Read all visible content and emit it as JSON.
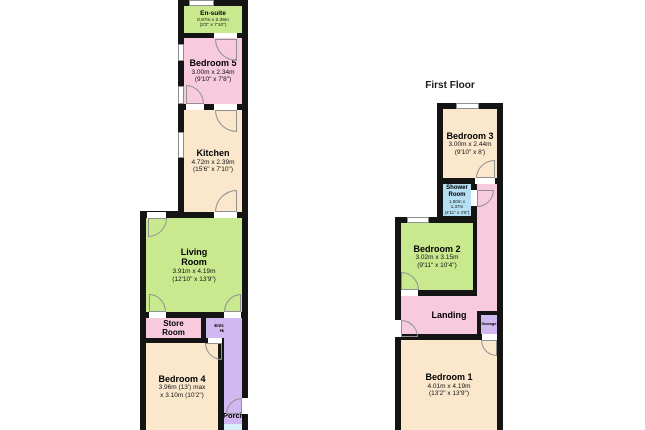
{
  "colors": {
    "wall": "#141414",
    "green": "#c9e98f",
    "pink": "#f7cade",
    "cream": "#fbe8cc",
    "lilac": "#d2b8f0",
    "blue": "#b5dff2",
    "porch_blue": "#d8eefb",
    "arc": "#909090",
    "window_frame": "#8e8e8e"
  },
  "first_floor_title": "First Floor",
  "ground": {
    "en_suite": {
      "name": "En-suite",
      "metric": "0.97m x 2.39m",
      "imperial": "(3'2\" x 7'10\")"
    },
    "bedroom5": {
      "name": "Bedroom 5",
      "metric": "3.00m x 2.34m",
      "imperial": "(9'10\" x 7'8\")"
    },
    "kitchen": {
      "name": "Kitchen",
      "metric": "4.72m x 2.39m",
      "imperial": "(15'6\" x 7'10\")"
    },
    "living_room": {
      "name": "Living Room",
      "metric": "3.91m x 4.19m",
      "imperial": "(12'10\" x 13'9\")"
    },
    "store_room": {
      "name": "Store Room"
    },
    "entrance_hall": {
      "name": "Entrance Hall"
    },
    "bedroom4": {
      "name": "Bedroom 4",
      "metric": "3.96m (13') max",
      "imperial": "x 3.10m (10'2\")"
    },
    "porch": {
      "name": "Porch"
    }
  },
  "first": {
    "bedroom3": {
      "name": "Bedroom 3",
      "metric": "3.00m x 2.44m",
      "imperial": "(9'10\" x 8')"
    },
    "shower_room": {
      "name": "Shower Room",
      "metric": "1.50m x 1.37m",
      "imperial": "(4'11\" x 4'6\")"
    },
    "bedroom2": {
      "name": "Bedroom 2",
      "metric": "3.02m x 3.15m",
      "imperial": "(9'11\" x 10'4\")"
    },
    "landing": {
      "name": "Landing"
    },
    "storage": {
      "name": "Storage"
    },
    "bedroom1": {
      "name": "Bedroom 1",
      "metric": "4.01m x 4.19m",
      "imperial": "(13'2\" x 13'9\")"
    }
  }
}
